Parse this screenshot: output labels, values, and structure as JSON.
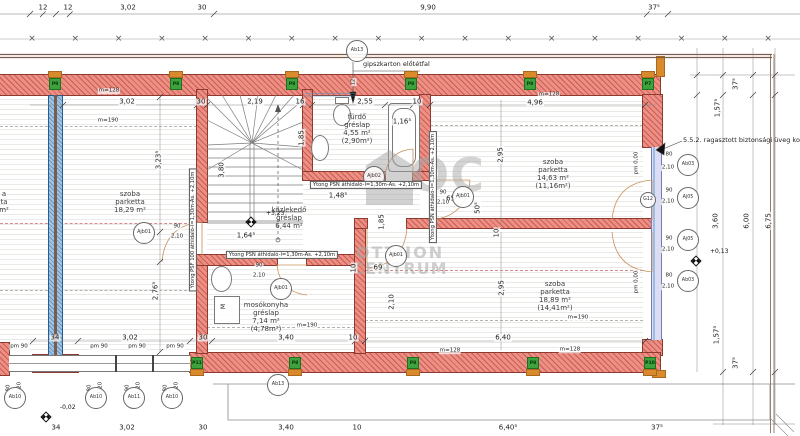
{
  "watermark": {
    "logo": "OC",
    "line1": "OTTHON",
    "line2": "CENTRUM"
  },
  "notes": {
    "gipszkarton": "gipszkarton előtétfal",
    "railing": "5.5.2. ragasztott biztonsági üveg korlát"
  },
  "fixtures": {
    "washer_label": "M"
  },
  "plan": {
    "grid_crosses": {
      "y": 39,
      "start": 32,
      "step": 43.3,
      "count": 18,
      "glyph": "×"
    },
    "rooms": [
      {
        "cx": 130,
        "ty": 190,
        "lines": [
          "szoba",
          "parketta",
          "18,29 m²"
        ]
      },
      {
        "cx": 553,
        "ty": 158,
        "lines": [
          "szoba",
          "parketta",
          "14,63 m²",
          "(11,16m²)"
        ]
      },
      {
        "cx": 555,
        "ty": 280,
        "lines": [
          "szoba",
          "parketta",
          "18,89 m²",
          "(14,41m²)"
        ]
      },
      {
        "cx": 357,
        "ty": 113,
        "lines": [
          "fürdő",
          "gréslap",
          "4,55 m²",
          "(2,90m²)"
        ]
      },
      {
        "cx": 289,
        "ty": 206,
        "lines": [
          "közlekedő",
          "gréslap",
          "6,44 m²"
        ]
      },
      {
        "cx": 266,
        "ty": 301,
        "lines": [
          "mosókonyha",
          "gréslap",
          "7,14 m²",
          "(4,78m²)"
        ]
      },
      {
        "cx": 4,
        "ty": 190,
        "lines": [
          "a",
          "ta",
          "m²"
        ]
      }
    ],
    "dims": [
      {
        "t": "12",
        "x": 43,
        "y": 8
      },
      {
        "t": "12",
        "x": 68,
        "y": 8
      },
      {
        "t": "3,02",
        "x": 128,
        "y": 8
      },
      {
        "t": "30",
        "x": 202,
        "y": 8
      },
      {
        "t": "9,90",
        "x": 428,
        "y": 8
      },
      {
        "t": "37⁵",
        "x": 654,
        "y": 8
      },
      {
        "t": "m=128",
        "x": 109,
        "y": 91,
        "s": 5.5
      },
      {
        "t": "3,02",
        "x": 127,
        "y": 102
      },
      {
        "t": "30",
        "x": 201,
        "y": 102
      },
      {
        "t": "2,19",
        "x": 255,
        "y": 102
      },
      {
        "t": "16",
        "x": 300,
        "y": 102
      },
      {
        "t": "2,55",
        "x": 365,
        "y": 102
      },
      {
        "t": "10",
        "x": 417,
        "y": 102
      },
      {
        "t": "4,96",
        "x": 535,
        "y": 103
      },
      {
        "t": "m=128",
        "x": 549,
        "y": 95,
        "s": 5.5
      },
      {
        "t": "m=190",
        "x": 108,
        "y": 121,
        "s": 5.5
      },
      {
        "t": "m=190",
        "x": 578,
        "y": 318,
        "s": 5.5
      },
      {
        "t": "m=128",
        "x": 570,
        "y": 350,
        "s": 5.5
      },
      {
        "t": "m=190",
        "x": 307,
        "y": 326,
        "s": 5.5
      },
      {
        "t": "3,23⁵",
        "x": 159,
        "y": 160,
        "r": 1
      },
      {
        "t": "2,76⁵",
        "x": 156,
        "y": 291,
        "r": 1
      },
      {
        "t": "3,80",
        "x": 222,
        "y": 170,
        "r": 1
      },
      {
        "t": "1,85",
        "x": 302,
        "y": 138,
        "r": 1
      },
      {
        "t": "1,85",
        "x": 382,
        "y": 222,
        "r": 1
      },
      {
        "t": "2,95",
        "x": 501,
        "y": 155,
        "r": 1
      },
      {
        "t": "2,95",
        "x": 502,
        "y": 288,
        "r": 1
      },
      {
        "t": "2,10",
        "x": 392,
        "y": 302,
        "r": 1
      },
      {
        "t": "50⁵",
        "x": 478,
        "y": 208,
        "r": 1
      },
      {
        "t": "10",
        "x": 497,
        "y": 233,
        "r": 1
      },
      {
        "t": "10",
        "x": 354,
        "y": 268,
        "r": 1
      },
      {
        "t": "12",
        "x": 354,
        "y": 82,
        "r": 1,
        "s": 5
      },
      {
        "t": "pm 0,00",
        "x": 637,
        "y": 163,
        "r": 1,
        "s": 5.5
      },
      {
        "t": "pm 0,00",
        "x": 637,
        "y": 282,
        "r": 1,
        "s": 5.5
      },
      {
        "t": "1,16⁵",
        "x": 402,
        "y": 122
      },
      {
        "t": "1,48⁵",
        "x": 338,
        "y": 196
      },
      {
        "t": "65⁵",
        "x": 452,
        "y": 199
      },
      {
        "t": "1,64⁵",
        "x": 246,
        "y": 236
      },
      {
        "t": "69",
        "x": 378,
        "y": 268
      },
      {
        "t": "90",
        "x": 177,
        "y": 227,
        "s": 5.5
      },
      {
        "t": "2,10",
        "x": 177,
        "y": 237,
        "s": 5.5
      },
      {
        "t": "90",
        "x": 443,
        "y": 193,
        "s": 5.5
      },
      {
        "t": "2,10",
        "x": 443,
        "y": 203,
        "s": 5.5
      },
      {
        "t": "90",
        "x": 259,
        "y": 266,
        "s": 5.5
      },
      {
        "t": "2,10",
        "x": 259,
        "y": 276,
        "s": 5.5
      },
      {
        "t": "80",
        "x": 9,
        "y": 388,
        "r": 1,
        "s": 5.5
      },
      {
        "t": "1,20",
        "x": 20,
        "y": 388,
        "r": 1,
        "s": 5.5
      },
      {
        "t": "80",
        "x": 90,
        "y": 388,
        "r": 1,
        "s": 5.5
      },
      {
        "t": "1,20",
        "x": 101,
        "y": 388,
        "r": 1,
        "s": 5.5
      },
      {
        "t": "90",
        "x": 128,
        "y": 388,
        "r": 1,
        "s": 5.5
      },
      {
        "t": "1,20",
        "x": 139,
        "y": 388,
        "r": 1,
        "s": 5.5
      },
      {
        "t": "80",
        "x": 166,
        "y": 388,
        "r": 1,
        "s": 5.5
      },
      {
        "t": "1,20",
        "x": 177,
        "y": 388,
        "r": 1,
        "s": 5.5
      },
      {
        "t": "80",
        "x": 669,
        "y": 155,
        "s": 5.5
      },
      {
        "t": "2,10",
        "x": 668,
        "y": 168,
        "s": 5.5
      },
      {
        "t": "90",
        "x": 669,
        "y": 191,
        "s": 5.5
      },
      {
        "t": "2,10",
        "x": 668,
        "y": 202,
        "s": 5.5
      },
      {
        "t": "90",
        "x": 669,
        "y": 239,
        "s": 5.5
      },
      {
        "t": "2,10",
        "x": 668,
        "y": 250,
        "s": 5.5
      },
      {
        "t": "80",
        "x": 669,
        "y": 276,
        "s": 5.5
      },
      {
        "t": "2,10",
        "x": 668,
        "y": 287,
        "s": 5.5
      },
      {
        "t": "37⁵",
        "x": 736,
        "y": 84,
        "r": 1
      },
      {
        "t": "1,57⁵",
        "x": 718,
        "y": 108,
        "r": 1
      },
      {
        "t": "3,60",
        "x": 716,
        "y": 221,
        "r": 1
      },
      {
        "t": "6,00",
        "x": 747,
        "y": 221,
        "r": 1
      },
      {
        "t": "6,75",
        "x": 769,
        "y": 221,
        "r": 1
      },
      {
        "t": "1,57⁵",
        "x": 717,
        "y": 335,
        "r": 1
      },
      {
        "t": "37⁵",
        "x": 736,
        "y": 363,
        "r": 1
      },
      {
        "t": "pm 90",
        "x": 19,
        "y": 347,
        "s": 5.5
      },
      {
        "t": "pm 90",
        "x": 99,
        "y": 347,
        "s": 5.5
      },
      {
        "t": "pm 90",
        "x": 137,
        "y": 347,
        "s": 5.5
      },
      {
        "t": "pm 90",
        "x": 175,
        "y": 347,
        "s": 5.5
      },
      {
        "t": "34",
        "x": 55,
        "y": 338
      },
      {
        "t": "3,02",
        "x": 130,
        "y": 338
      },
      {
        "t": "30",
        "x": 203,
        "y": 338
      },
      {
        "t": "3,40",
        "x": 286,
        "y": 338
      },
      {
        "t": "10",
        "x": 353,
        "y": 338
      },
      {
        "t": "6,40",
        "x": 503,
        "y": 338
      },
      {
        "t": "m=128",
        "x": 450,
        "y": 351,
        "s": 5.5
      },
      {
        "t": "34",
        "x": 56,
        "y": 428
      },
      {
        "t": "3,02",
        "x": 127,
        "y": 428
      },
      {
        "t": "30",
        "x": 203,
        "y": 428
      },
      {
        "t": "3,40",
        "x": 286,
        "y": 428
      },
      {
        "t": "10",
        "x": 357,
        "y": 428
      },
      {
        "t": "6,40⁵",
        "x": 508,
        "y": 428
      },
      {
        "t": "37⁵",
        "x": 657,
        "y": 428
      }
    ],
    "circles": [
      {
        "t": "Ab13",
        "x": 357,
        "y": 51
      },
      {
        "t": "Ab13",
        "x": 278,
        "y": 385
      },
      {
        "t": "Ajb02",
        "x": 374,
        "y": 177
      },
      {
        "t": "Ajb01",
        "x": 463,
        "y": 197
      },
      {
        "t": "Ajb01",
        "x": 281,
        "y": 289
      },
      {
        "t": "Ajb01",
        "x": 396,
        "y": 256
      },
      {
        "t": "Ajb01",
        "x": 144,
        "y": 233
      },
      {
        "t": "G12",
        "x": 648,
        "y": 200,
        "r": 8
      },
      {
        "t": "Ab03",
        "x": 688,
        "y": 165
      },
      {
        "t": "Aj05",
        "x": 688,
        "y": 198
      },
      {
        "t": "Aj05",
        "x": 688,
        "y": 240
      },
      {
        "t": "Ab03",
        "x": 688,
        "y": 281
      },
      {
        "t": "Ab10",
        "x": 15,
        "y": 398
      },
      {
        "t": "Ab10",
        "x": 96,
        "y": 398
      },
      {
        "t": "Ab11",
        "x": 134,
        "y": 398
      },
      {
        "t": "Ab10",
        "x": 172,
        "y": 398
      }
    ],
    "pilasters": [
      {
        "t": "P9",
        "x": 55,
        "y": 84,
        "cap": "top"
      },
      {
        "t": "P8",
        "x": 176,
        "y": 84,
        "cap": "top"
      },
      {
        "t": "P8",
        "x": 292,
        "y": 84,
        "cap": "top"
      },
      {
        "t": "P8",
        "x": 411,
        "y": 84,
        "cap": "top"
      },
      {
        "t": "P8",
        "x": 530,
        "y": 84,
        "cap": "top"
      },
      {
        "t": "P7",
        "x": 648,
        "y": 84,
        "cap": "top"
      },
      {
        "t": "P11",
        "x": 197,
        "y": 363,
        "cap": "bottom"
      },
      {
        "t": "P8",
        "x": 295,
        "y": 363,
        "cap": "bottom"
      },
      {
        "t": "P8",
        "x": 413,
        "y": 363,
        "cap": "bottom"
      },
      {
        "t": "P8",
        "x": 533,
        "y": 363,
        "cap": "bottom"
      },
      {
        "t": "P10",
        "x": 650,
        "y": 363,
        "cap": "bottom"
      }
    ],
    "levels": [
      {
        "t": "+3,23",
        "x": 266,
        "y": 213,
        "dx": 251,
        "dy": 222
      },
      {
        "t": "+0,13",
        "x": 710,
        "y": 251,
        "dx": 696,
        "dy": 261
      },
      {
        "t": "-0,02",
        "x": 60,
        "y": 407,
        "dx": 46,
        "dy": 417
      }
    ],
    "lintels": [
      {
        "t": "Ytong PSN áthidaló-l=1,30m-As. +2,10m",
        "x": 366,
        "y": 185
      },
      {
        "t": "Ytong PSN áthidaló-l=1,30m-As. +2,10m",
        "x": 282,
        "y": 255
      },
      {
        "t": "Ytong PSN áthidaló-l=1,30m-As. +2,10m",
        "x": 433,
        "y": 187,
        "r": 1
      },
      {
        "t": "Ytong PSF 100 áthidaló-l=1,30m-As. +2,10m",
        "x": 193,
        "y": 230,
        "r": 1
      }
    ]
  }
}
